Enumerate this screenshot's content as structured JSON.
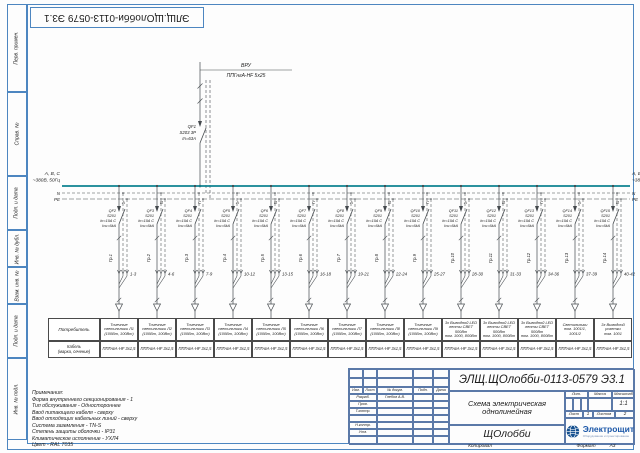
{
  "colors": {
    "frame": "#4d86c0",
    "bus": "#0e8290",
    "line": "#44494d",
    "stamp_border": "#5b79a8",
    "logo_blue": "#1b57a8"
  },
  "doc_number_top": "ЭЛЩ.ЩОлобби-0113-0579 Э3.1",
  "margin_labels": [
    {
      "label": "Перв. примен.",
      "h": 88
    },
    {
      "label": "Справ. №",
      "h": 84
    },
    {
      "label": "Подп. и дата",
      "h": 54
    },
    {
      "label": "Инв. № дубл.",
      "h": 37
    },
    {
      "label": "Взам. инв. №",
      "h": 37
    },
    {
      "label": "Подп. и дата",
      "h": 54
    },
    {
      "label": "Инв. № подл.",
      "h": 82
    }
  ],
  "incoming": {
    "source": "ВРУ",
    "cable": "ППГнгА-HF 5х25",
    "breaker": [
      "QF1",
      "S203 3P",
      "In=63A"
    ]
  },
  "bus": {
    "phases": "A, B, C",
    "voltage": "~380В, 50Гц",
    "n": "N",
    "pe": "PE"
  },
  "feeder_common": {
    "model": "S201",
    "spec1": "In=10A C",
    "spec2": "Icu=6kA"
  },
  "feeders": [
    {
      "qf": "QF2",
      "phase": "A",
      "group": "Гр.1",
      "wires": "1-3"
    },
    {
      "qf": "QF3",
      "phase": "B",
      "group": "Гр.2",
      "wires": "4-6"
    },
    {
      "qf": "QF4",
      "phase": "C",
      "group": "Гр.3",
      "wires": "7-9"
    },
    {
      "qf": "QF5",
      "phase": "A",
      "group": "Гр.4",
      "wires": "10-12"
    },
    {
      "qf": "QF6",
      "phase": "B",
      "group": "Гр.5",
      "wires": "13-15"
    },
    {
      "qf": "QF7",
      "phase": "C",
      "group": "Гр.6",
      "wires": "16-18"
    },
    {
      "qf": "QF8",
      "phase": "A",
      "group": "Гр.7",
      "wires": "19-21"
    },
    {
      "qf": "QF9",
      "phase": "B",
      "group": "Гр.8",
      "wires": "22-24"
    },
    {
      "qf": "QF10",
      "phase": "C",
      "group": "Гр.9",
      "wires": "25-27"
    },
    {
      "qf": "QF11",
      "phase": "A",
      "group": "Гр.10",
      "wires": "28-30"
    },
    {
      "qf": "QF12",
      "phase": "B",
      "group": "Гр.11",
      "wires": "31-33"
    },
    {
      "qf": "QF13",
      "phase": "C",
      "group": "Гр.12",
      "wires": "34-36"
    },
    {
      "qf": "QF14",
      "phase": "A",
      "group": "Гр.13",
      "wires": "37-39"
    },
    {
      "qf": "QF15",
      "phase": "B",
      "group": "Гр.14",
      "wires": "40-42"
    }
  ],
  "table": {
    "row1_header": "Потребитель",
    "row2_header_l1": "Кабель",
    "row2_header_l2": "(марка, сечение)",
    "columns": [
      {
        "consumer": [
          "Точечные",
          "светильники Л1",
          "(100Вт, 100Вт)"
        ],
        "cable": "ППГнгА-HF 3х1,5"
      },
      {
        "consumer": [
          "Точечные",
          "светильники Л2",
          "(100Вт, 100Вт)"
        ],
        "cable": "ППГнгА-HF 3х1,5"
      },
      {
        "consumer": [
          "Точечные",
          "светильники Л3",
          "(100Вт, 100Вт)"
        ],
        "cable": "ППГнгА-HF 3х1,5"
      },
      {
        "consumer": [
          "Точечные",
          "светильники Л4",
          "(100Вт, 100Вт)"
        ],
        "cable": "ППГнгА-HF 3х1,5"
      },
      {
        "consumer": [
          "Точечные",
          "светильники Л5",
          "(100Вт, 100Вт)"
        ],
        "cable": "ППГнгА-HF 3х1,5"
      },
      {
        "consumer": [
          "Точечные",
          "светильники Л6",
          "(100Вт, 100Вт)"
        ],
        "cable": "ППГнгА-HF 3х1,5"
      },
      {
        "consumer": [
          "Точечные",
          "светильники Л7",
          "(100Вт, 100Вт)"
        ],
        "cable": "ППГнгА-HF 3х1,5"
      },
      {
        "consumer": [
          "Точечные",
          "светильники Л8",
          "(100Вт, 100Вт)"
        ],
        "cable": "ППГнгА-HF 3х1,5"
      },
      {
        "consumer": [
          "Точечные",
          "светильники Л9",
          "(100Вт, 100Вт)"
        ],
        "cable": "ППГнгА-HF 3х1,5"
      },
      {
        "consumer": [
          "3х Выводной LED",
          "ленты СВЕТ 500Вт",
          "пом. 1000, 800Вт"
        ],
        "cable": "ППГнгА-HF 3х1,5"
      },
      {
        "consumer": [
          "3х Выводной LED",
          "ленты СВЕТ 500Вт",
          "пом. 1000, 800Вт"
        ],
        "cable": "ППГнгА-HF 3х1,5"
      },
      {
        "consumer": [
          "3х Выводной LED",
          "ленты СВЕТ 500Вт",
          "пом. 1000, 800Вт"
        ],
        "cable": "ППГнгА-HF 3х1,5"
      },
      {
        "consumer": [
          "Светильники",
          "пом. 1001/1,",
          "1001/2"
        ],
        "cable": "ППГнгА-HF 3х1,5"
      },
      {
        "consumer": [
          "3х Выводной",
          "розетки",
          "пом. 1001"
        ],
        "cable": "ППГнгА-HF 3х1,5"
      }
    ]
  },
  "notes": {
    "title": "Примечания:",
    "lines": [
      "Форма внутреннего секционирования - 1",
      "Тип обслуживания - Одностороннее",
      "Ввод питающего кабеля - сверху",
      "Ввод отходящих кабельных линий - сверху",
      "Система заземления - TN-S",
      "Степень защиты оболочки - IP31",
      "Климатическое исполнение - УХЛ4",
      "Цвет - RAL 7035"
    ]
  },
  "stamp": {
    "doc_number": "ЭЛЩ.ЩОлобби-0113-0579 Э3.1",
    "title_line1": "Схема электрическая",
    "title_line2": "однолинейная",
    "object_name": "ЩОлобби",
    "header_cols": [
      "Изм.",
      "Лист",
      "№ докум.",
      "Подп.",
      "Дата"
    ],
    "rows": [
      [
        "Разраб.",
        "Глебов А.В."
      ],
      [
        "Пров.",
        ""
      ],
      [
        "Т.контр.",
        ""
      ],
      [
        "",
        ""
      ],
      [
        "Н.контр.",
        ""
      ],
      [
        "Утв.",
        ""
      ]
    ],
    "lit_label": "Лит.",
    "mass_label": "Масса",
    "scale_label": "Масштаб",
    "scale_value": "1:1",
    "sheet_label": "Лист",
    "sheet_value": "1",
    "sheets_label": "Листов",
    "sheets_value": "2",
    "copied": "Копировал",
    "format_label": "Формат",
    "format_value": "А3",
    "logo_text": "Электрощит",
    "logo_tagline": "Оборудование и проектирование"
  }
}
